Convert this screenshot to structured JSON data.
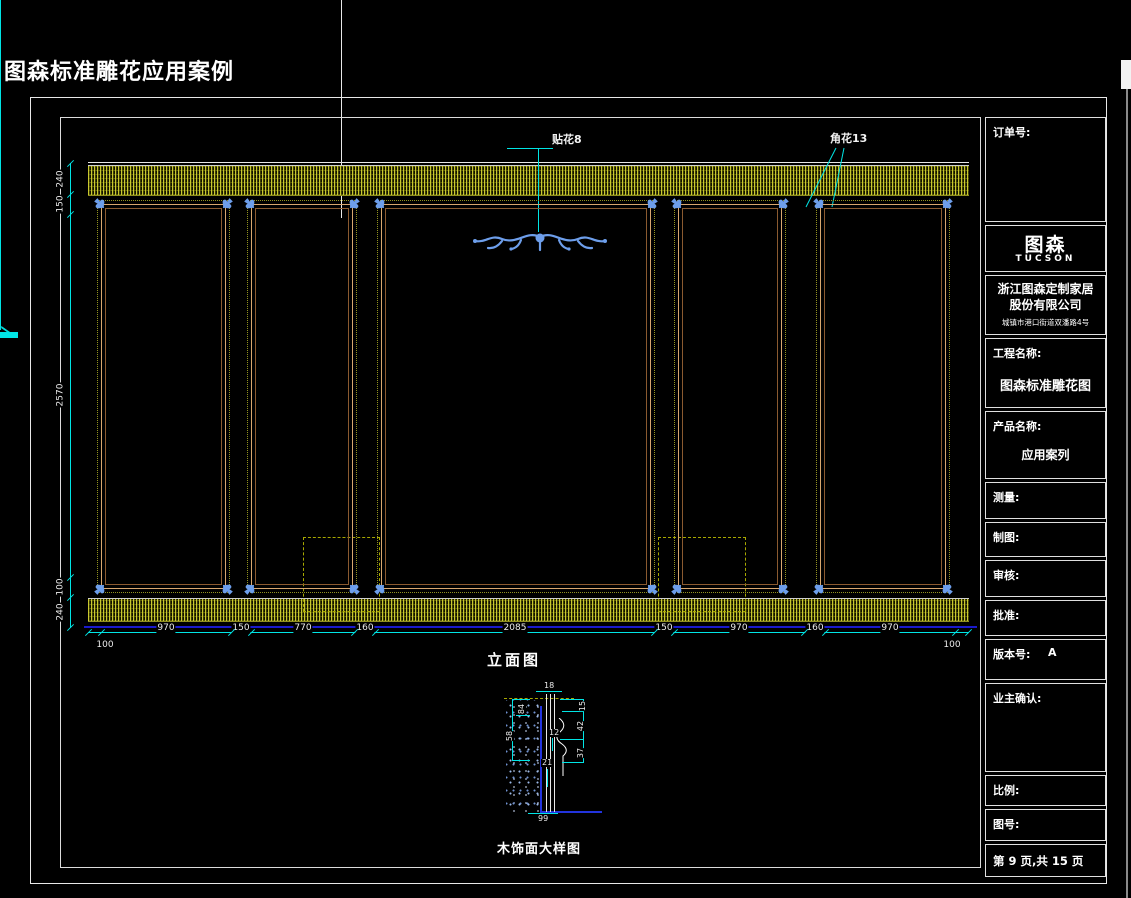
{
  "page_title": "图森标准雕花应用案例",
  "callouts": {
    "decal": "贴花8",
    "corner_flower": "角花13"
  },
  "captions": {
    "elevation": "立面图",
    "detail": "木饰面大样图"
  },
  "title_block": {
    "order_no_label": "订单号:",
    "logo": "图森",
    "logo_sub": "TUCSON",
    "company_line1": "浙江图森定制家居",
    "company_line2": "股份有限公司",
    "company_address": "城镇市港口街道双潘路4号",
    "project_label": "工程名称:",
    "project_value": "图森标准雕花图",
    "product_label": "产品名称:",
    "product_value": "应用案列",
    "measure_label": "测量:",
    "draft_label": "制图:",
    "review_label": "审核:",
    "approve_label": "批准:",
    "version_label": "版本号:",
    "version_value": "A",
    "owner_label": "业主确认:",
    "scale_label": "比例:",
    "drawing_no_label": "图号:",
    "page_info": "第 9 页,共 15 页"
  },
  "dimensions": {
    "bottom": [
      "100",
      "970",
      "150",
      "770",
      "160",
      "2085",
      "150",
      "970",
      "160",
      "970",
      "100"
    ],
    "left": [
      "240",
      "150",
      "2570",
      "100",
      "240"
    ],
    "detail": [
      "18",
      "15",
      "84",
      "58",
      "12",
      "42",
      "37",
      "21",
      "99"
    ]
  },
  "colors": {
    "dimension_cyan": "#00e5e5",
    "hatch_olive": "#9a9a00",
    "molding_tan": "#d8a76f",
    "ornament_blue": "#6d9eeb",
    "floor_blue": "#1a1acc",
    "line_white": "#e8e8e8"
  }
}
